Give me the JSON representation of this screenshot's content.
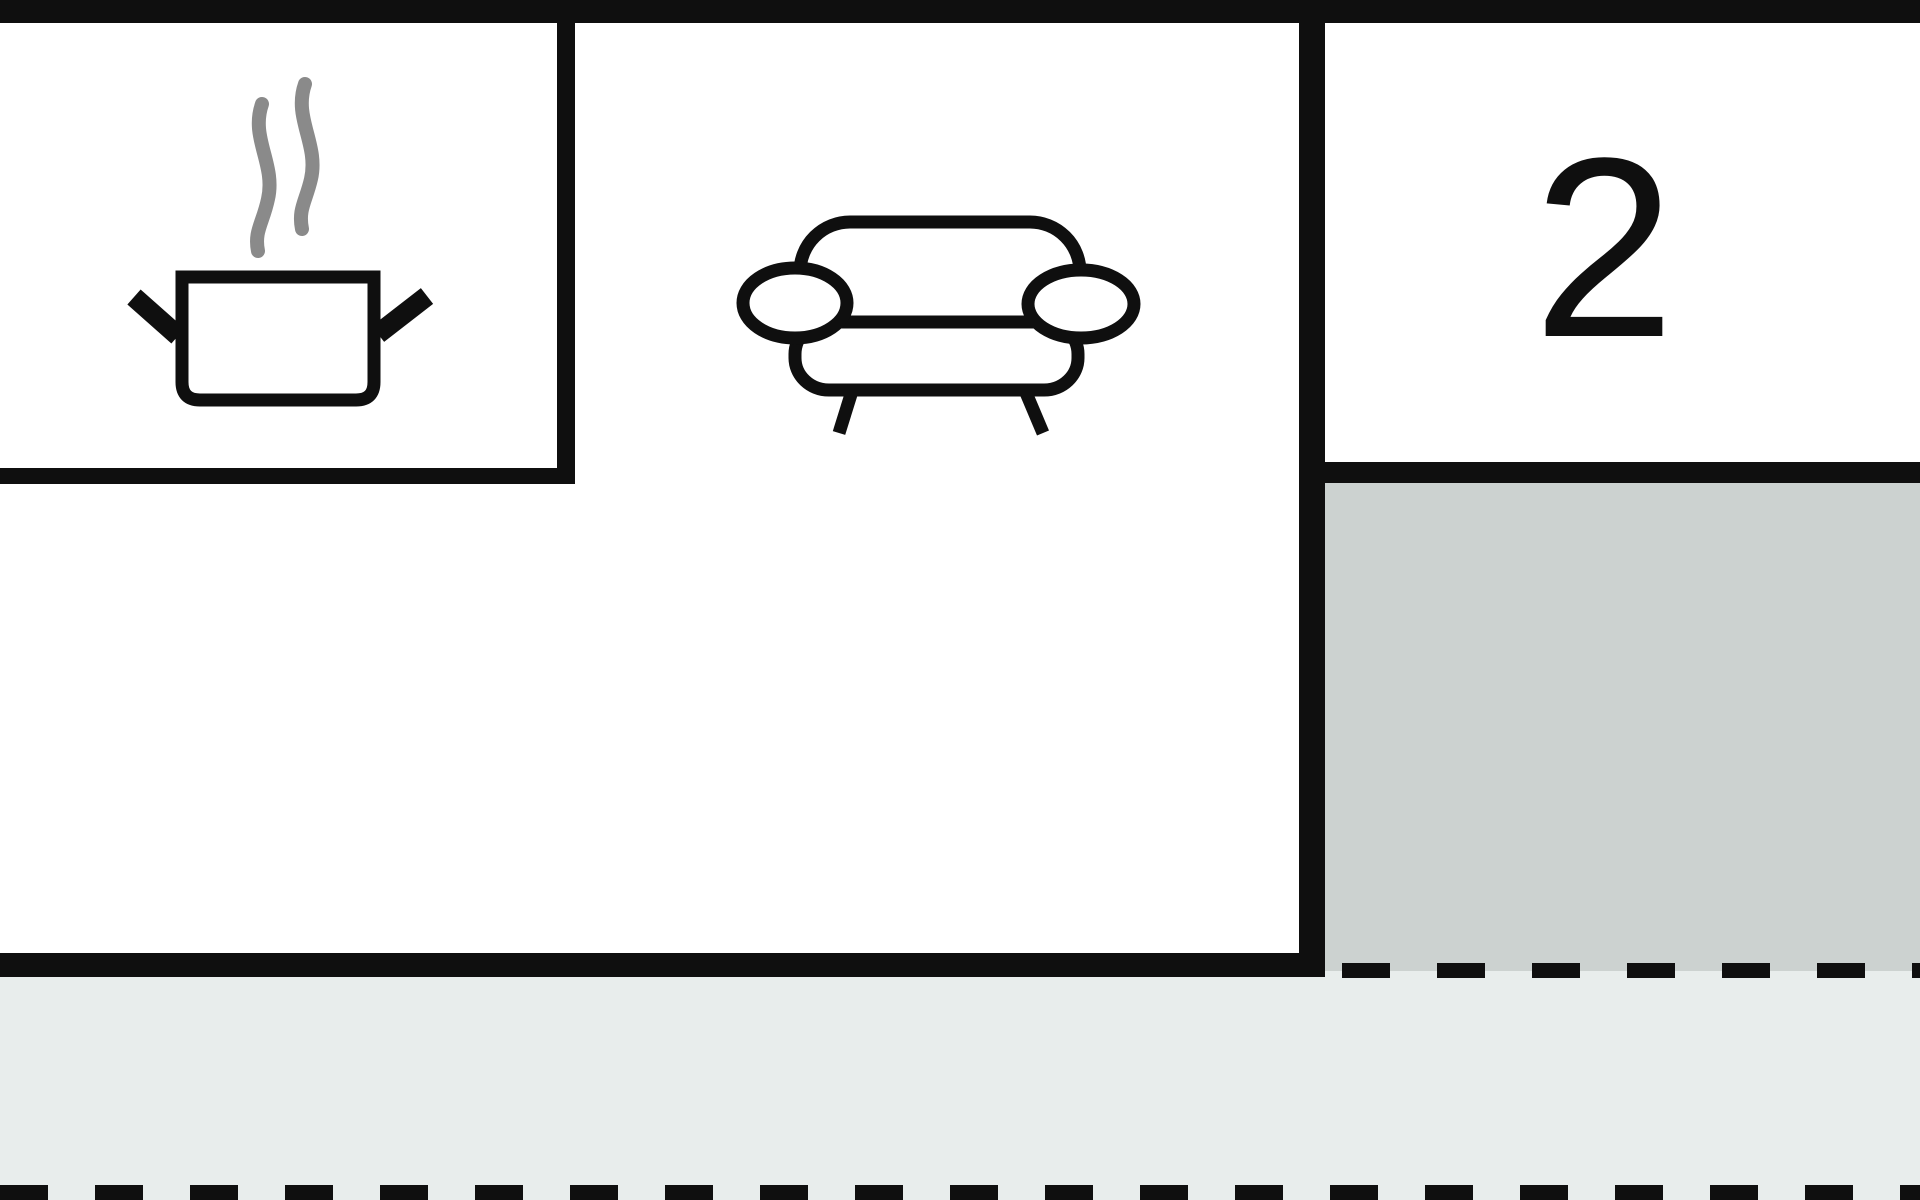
{
  "floorplan": {
    "title": "apartment-floor-plan-crop",
    "rooms": {
      "kitchen": {
        "icon": "cooking-pot-icon"
      },
      "living": {
        "icon": "sofa-icon"
      },
      "bedroom": {
        "label": "2"
      },
      "terrace_upper": {
        "style": "dark-gray-area"
      },
      "terrace_lower": {
        "style": "light-gray-strip"
      }
    },
    "colors": {
      "wall": "#0f0f0f",
      "terrace_dark": "#ccd2d0",
      "terrace_light": "#e8edec",
      "steam_gray": "#8a8a8a",
      "background": "#ffffff"
    }
  }
}
